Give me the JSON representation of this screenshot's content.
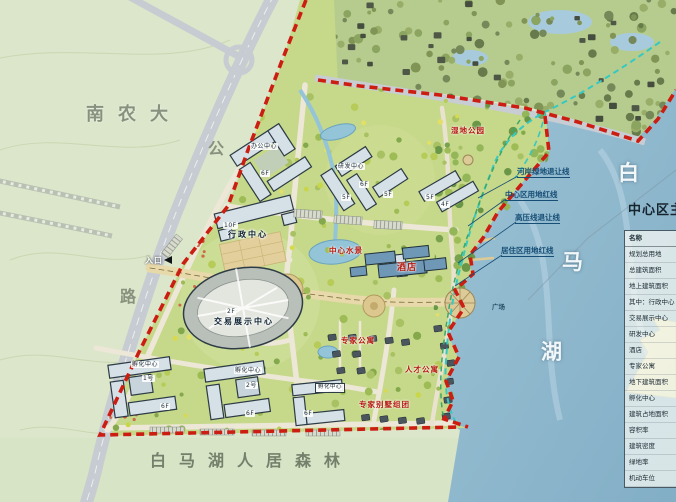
{
  "region_labels": {
    "university": "南农大",
    "road_char_1": "公",
    "road_char_2": "路",
    "forest": "白马湖人居森林",
    "lake_char_1": "白",
    "lake_char_2": "马",
    "lake_char_3": "湖"
  },
  "callouts": {
    "riverside_green": "河岸绿地退让线",
    "center_redline": "中心区用地红线",
    "highvoltage": "高压线退让线",
    "residential_redline": "居住区用地红线"
  },
  "buildings": {
    "admin_floors": "10F",
    "admin_name": "行政中心",
    "expo_floors": "2F",
    "expo_name": "交易展示中心",
    "hotel_name": "酒店",
    "office_name": "办公中心",
    "rnd_name": "研发中心",
    "incubator_name": "孵化中心",
    "incubator1_no": "1号",
    "incubator2_no": "2号",
    "floor_4f": "4F",
    "floor_5f": "5F",
    "floor_6f": "6F"
  },
  "poi_labels": {
    "entrance": "入口",
    "wetland": "湿地公园",
    "waterscape": "中心水景",
    "expert_apartment": "专家公寓",
    "talent_apartment": "人才公寓",
    "expert_villa": "专家别墅组团",
    "pier_plaza": "广场"
  },
  "legend": {
    "title": "中心区主要经济技术指标",
    "rows": [
      "名称",
      "规划总用地",
      "总建筑面积",
      "地上建筑面积",
      "其中：行政中心",
      "交易展示中心",
      "研发中心",
      "酒店",
      "专家公寓",
      "地下建筑面积",
      "孵化中心",
      "建筑占地面积",
      "容积率",
      "建筑密度",
      "绿地率",
      "机动车位"
    ]
  },
  "colors": {
    "boundary_red": "#cc1d12",
    "setback_cyan": "#36c9c2",
    "green_line": "#3aa869",
    "lake": "#8db8cd",
    "callout_blue": "#174e76"
  }
}
